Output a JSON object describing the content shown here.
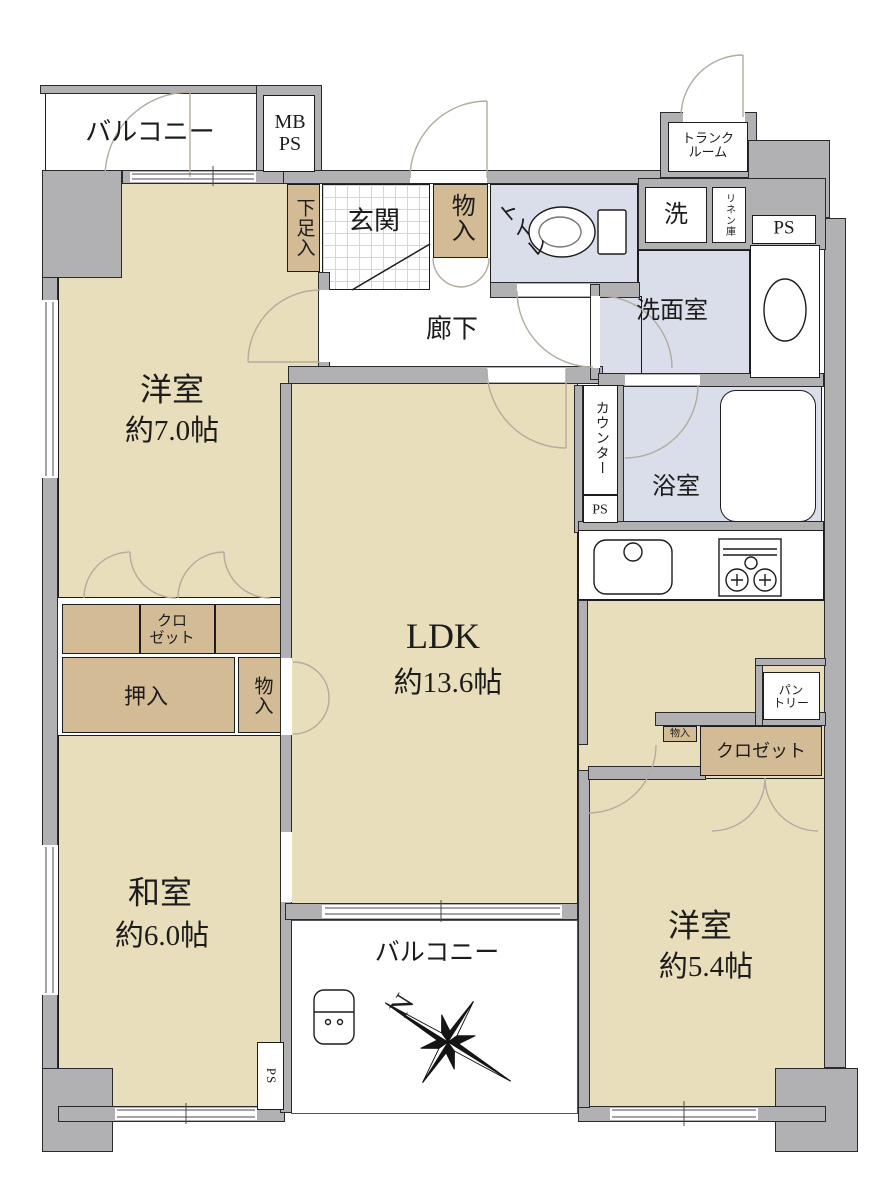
{
  "plan_title": "2LDK+S floor plan",
  "colors": {
    "floor_tan": "#e9debc",
    "closet_tan": "#d3bc95",
    "wet_blue": "#d9deea",
    "wall_gray": "#b1b1b4",
    "line": "#1c1c1c"
  },
  "rooms": {
    "west7": {
      "name": "洋室",
      "size": "約7.0帖"
    },
    "ldk": {
      "name": "LDK",
      "size": "約13.6帖"
    },
    "washitsu": {
      "name": "和室",
      "size": "約6.0帖"
    },
    "west54": {
      "name": "洋室",
      "size": "約5.4帖"
    },
    "genkan": "玄関",
    "corridor": "廊下",
    "toilet": "トイレ",
    "washroom": "洗面室",
    "bath": "浴室",
    "balcony_top": "バルコニー",
    "balcony_bottom": "バルコニー"
  },
  "storage": {
    "shoe": "下足入",
    "monoire_entry": "物入",
    "monoire_west": "物入",
    "monoire_small": "物入",
    "closet_west": "クロ\nゼット",
    "closet_east": "クロゼット",
    "oshiire": "押入",
    "pantry": "パン\nトリー",
    "linen": "リネン庫",
    "trunk": "トランク\nルーム"
  },
  "service": {
    "mbps": "MB\nPS",
    "ps_top": "PS",
    "ps_mid": "PS",
    "ps_bottom": "PS",
    "washer": "洗",
    "counter": "カウンター"
  },
  "compass": {
    "north": "N"
  }
}
